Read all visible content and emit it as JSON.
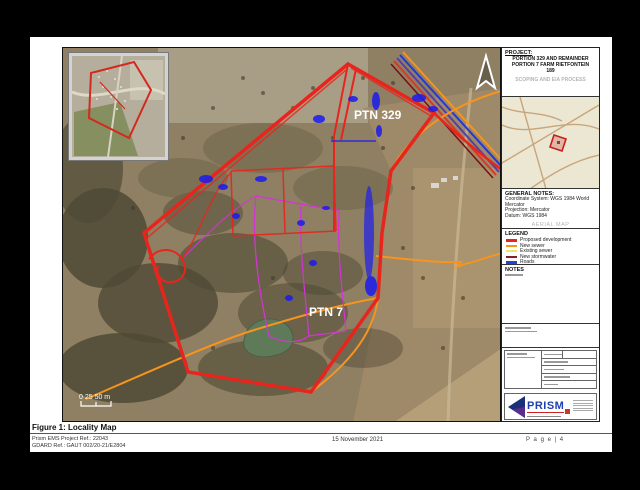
{
  "page": {
    "figure_caption": "Figure 1: Locality Map",
    "footer": {
      "project_ref": "Prism EMS Project Ref.: 22043",
      "gdard_ref": "GDARD Ref.:  GAUT 002/20-21/E2804",
      "date": "15 November 2021",
      "page_number": "P a g e  | 4"
    }
  },
  "map": {
    "labels": {
      "ptn329": "PTN 329",
      "ptn7": "PTN 7"
    },
    "scale_bar": {
      "text": "0  25 50 m"
    },
    "icons": {
      "north_arrow": "north-arrow"
    }
  },
  "panel": {
    "project": {
      "header": "PROJECT:",
      "line1": "PORTION 329 AND REMAINDER",
      "line2": "PORTION 7 FARM RIETFONTEIN",
      "line3": "189",
      "process": "SCOPING AND EIA PROCESS"
    },
    "general_notes": {
      "header": "GENERAL NOTES:",
      "lines": [
        "Coordinate System: WGS 1984 World",
        "Mercator",
        "Projection: Mercator",
        "Datum: WGS 1984"
      ],
      "map_type": "AERIAL MAP"
    },
    "legend": {
      "header": "LEGEND",
      "items": [
        {
          "label": "Proposed development",
          "color": "#e8251d"
        },
        {
          "label": "New sewer",
          "color": "#f7941d"
        },
        {
          "label": "Existing sewer",
          "color": "#f2e36b"
        },
        {
          "label": "New stormwater",
          "color": "#8c1d1d"
        },
        {
          "label": "Roads",
          "color": "#2b3fd4"
        },
        {
          "label": "Water",
          "color": "#2e8b8b"
        }
      ]
    },
    "notes": {
      "header": "NOTES"
    },
    "logo": {
      "brand": "PRISM"
    }
  },
  "colors": {
    "boundary_red": "#e8251d",
    "sewer_orange": "#f7941d",
    "magenta_line": "#d633d6",
    "services_blue": "#1b1bf0",
    "pond_green": "#5e7a58",
    "inset_bg": "#ece7d3"
  }
}
